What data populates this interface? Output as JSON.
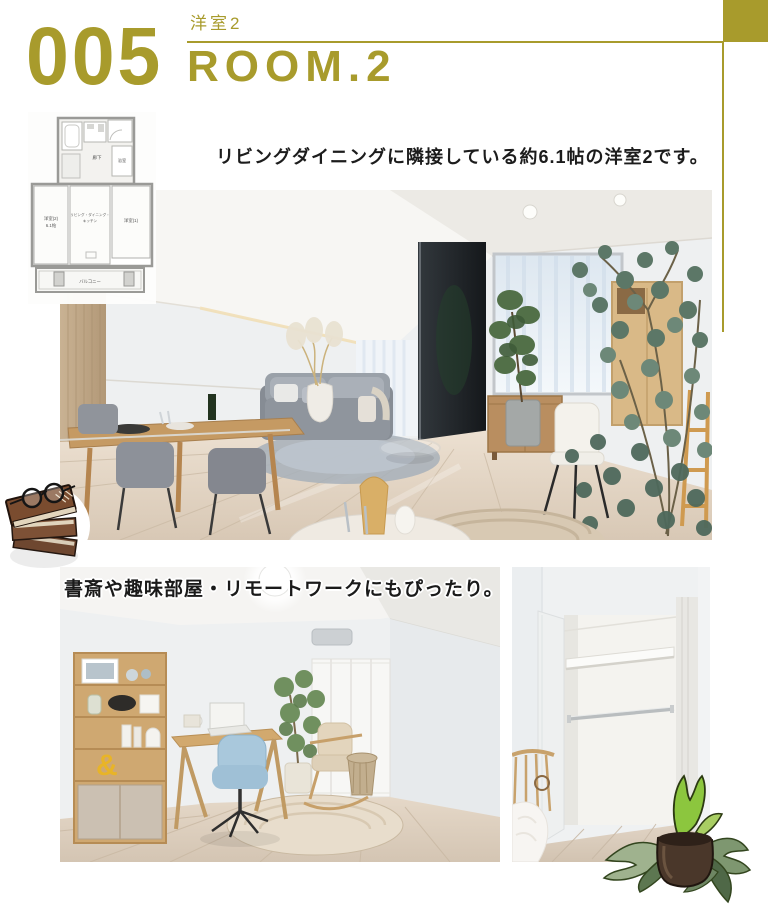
{
  "accent_color": "#a89b2c",
  "header": {
    "number": "005",
    "room_label_jp": "洋室2",
    "room_label_en": "ROOM.2"
  },
  "captions": {
    "main": "リビングダイニングに隣接している約6.1帖の洋室2です。",
    "secondary": "書斎や趣味部屋・リモートワークにもぴったり。"
  },
  "floor_plan": {
    "room2_label": "洋室(2)",
    "room2_size": "6.1帖",
    "ldk_line1": "リビング・ダイニング・",
    "ldk_line2": "キッチン",
    "room1_label": "洋室(1)",
    "hall_label": "廊下",
    "bath_label": "浴室",
    "balcony_label": "バルコニー"
  },
  "study_photo": {
    "ampersand_decor": "&"
  }
}
